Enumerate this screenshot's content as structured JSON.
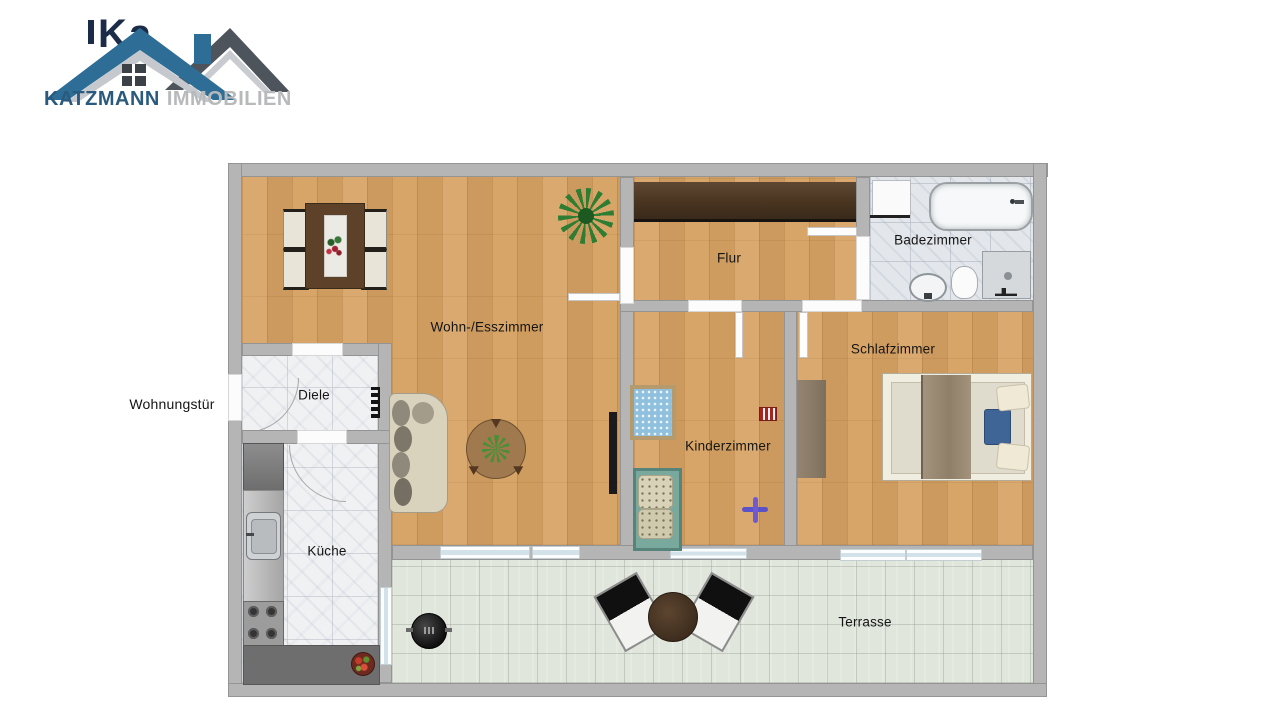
{
  "logo": {
    "company": "KATZMANN",
    "suffix": "IMMOBILIEN",
    "watermark": "Ka"
  },
  "plan": {
    "entrance_label": "Wohnungstür",
    "rooms": {
      "living": {
        "label": "Wohn-/Esszimmer"
      },
      "hall": {
        "label": "Flur"
      },
      "bath": {
        "label": "Badezimmer"
      },
      "bedroom": {
        "label": "Schlafzimmer"
      },
      "kids": {
        "label": "Kinderzimmer"
      },
      "foyer": {
        "label": "Diele"
      },
      "kitchen": {
        "label": "Küche"
      },
      "terrace": {
        "label": "Terrasse"
      }
    }
  },
  "colors": {
    "roof_blue": "#2d6d96",
    "roof_gray": "#4e545c",
    "brand_text": "#2a5b7e",
    "brand_muted": "#b7b9bb",
    "wood": "#d7a263",
    "wall_gray": "#b5b5b5",
    "terrace_tile": "#e1e6dd"
  }
}
